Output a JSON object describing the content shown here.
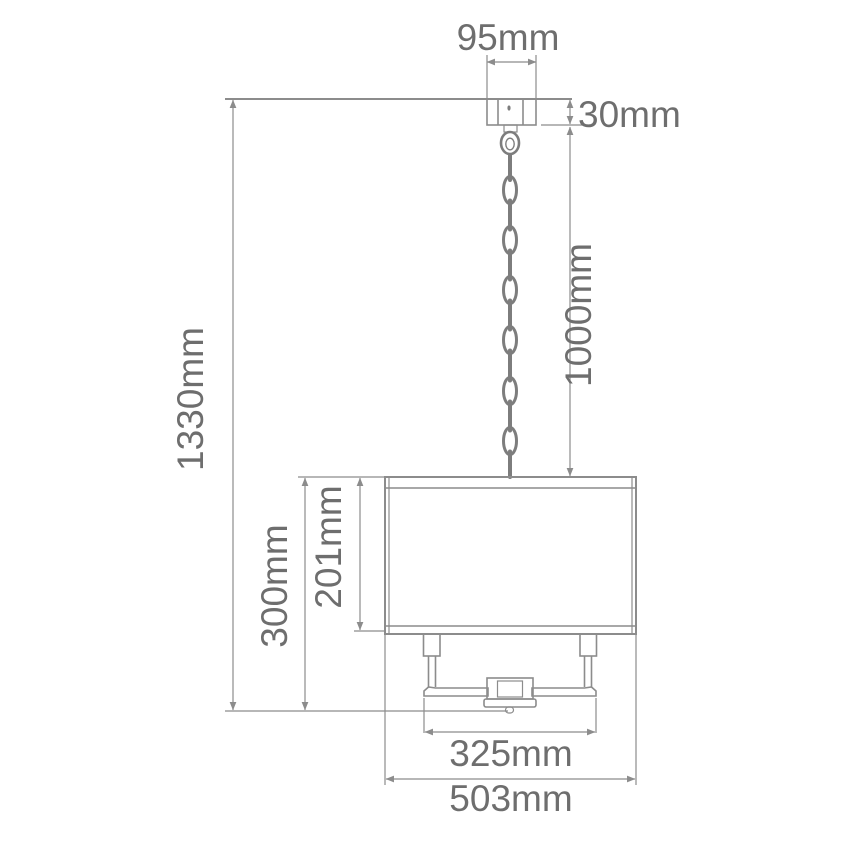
{
  "diagram": {
    "subject": "pendant-light-dimension-diagram",
    "colors": {
      "line-color": "#8c8c8c",
      "text-color": "#6e6e6e",
      "bg-color": "#ffffff"
    },
    "dimensions": {
      "canopy_width": {
        "label": "95mm",
        "value_mm": 95
      },
      "canopy_height": {
        "label": "30mm",
        "value_mm": 30
      },
      "chain_length": {
        "label": "1000mm",
        "value_mm": 1000
      },
      "total_height": {
        "label": "1330mm",
        "value_mm": 1330
      },
      "fixture_height": {
        "label": "300mm",
        "value_mm": 300
      },
      "shade_height": {
        "label": "201mm",
        "value_mm": 201
      },
      "frame_width": {
        "label": "325mm",
        "value_mm": 325
      },
      "shade_width": {
        "label": "503mm",
        "value_mm": 503
      }
    }
  }
}
